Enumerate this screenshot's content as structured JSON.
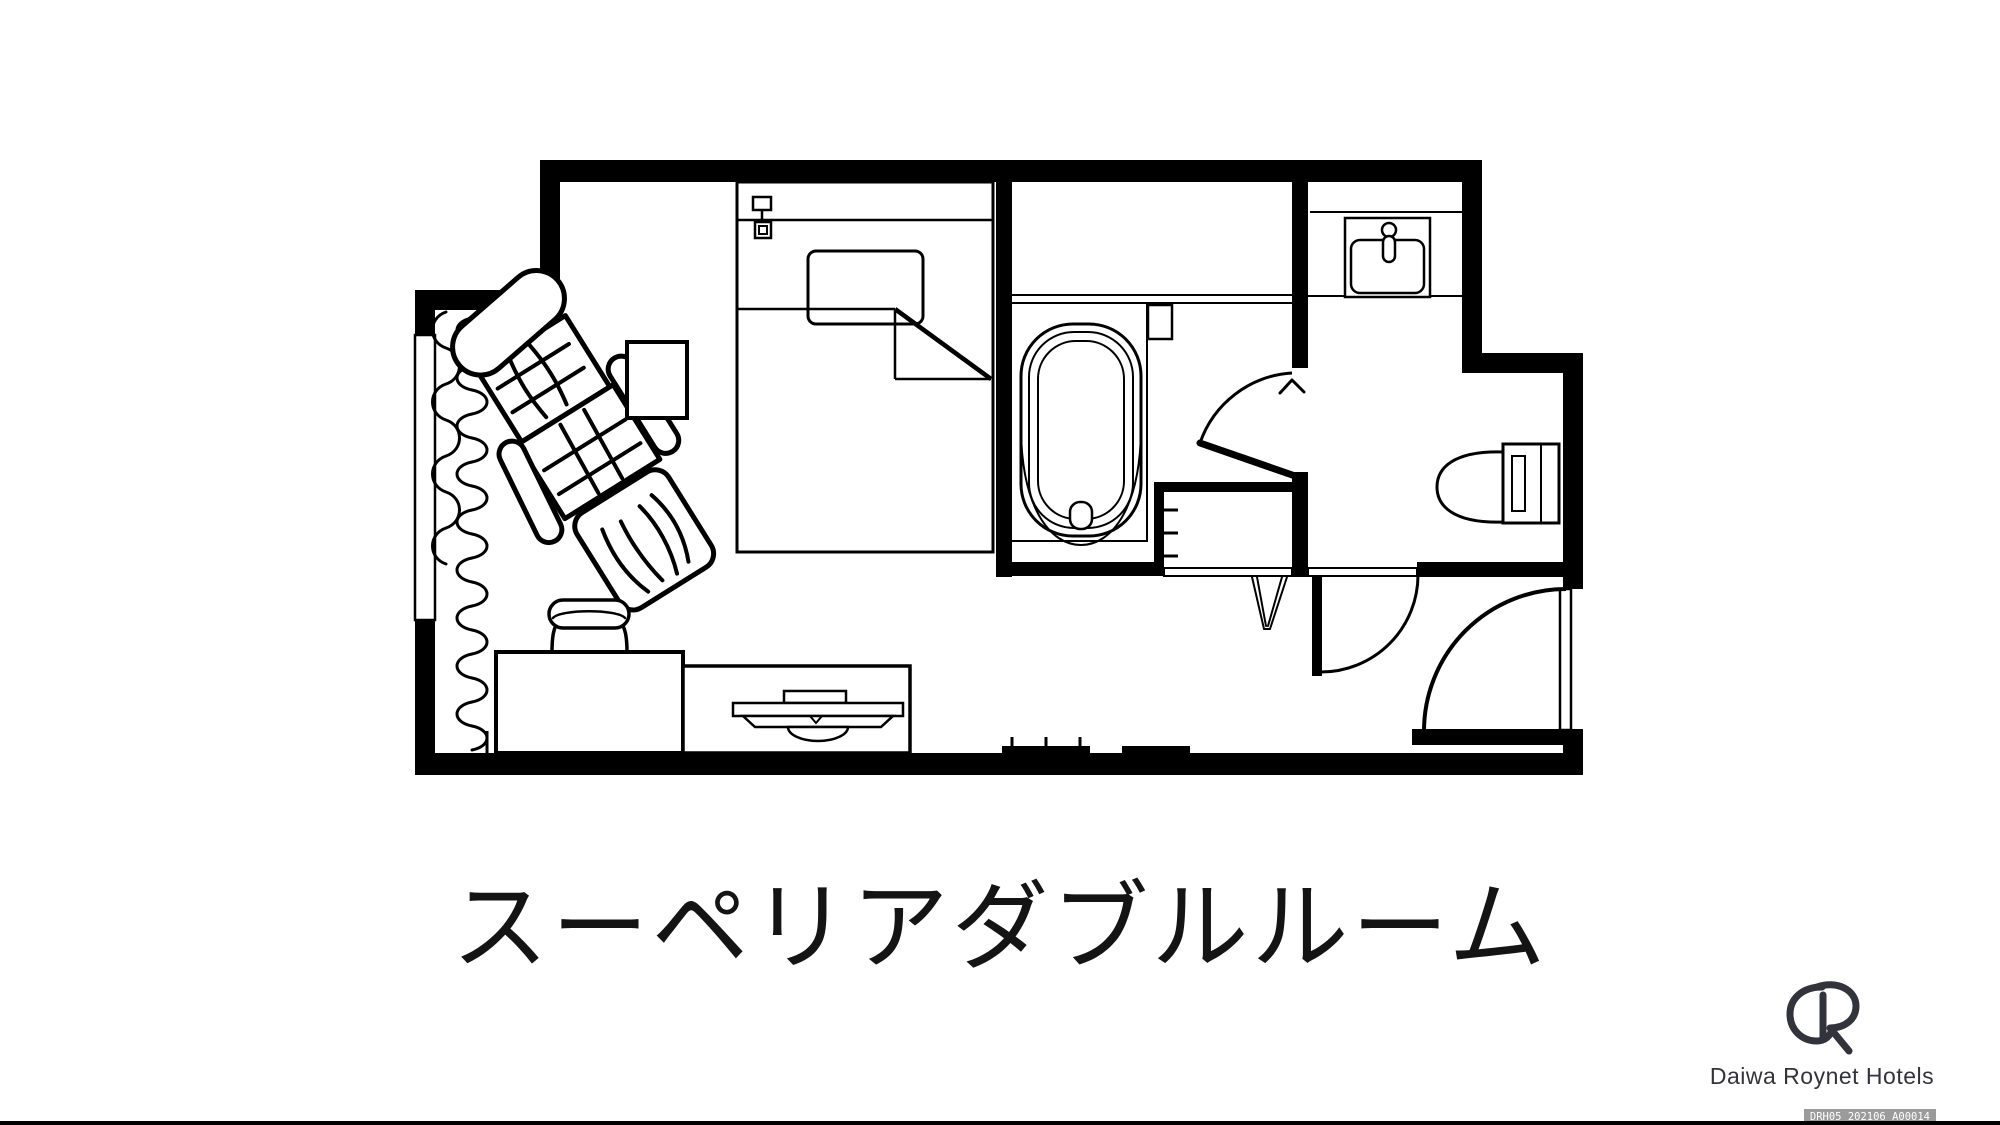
{
  "title": {
    "text": "スーペリアダブルルーム"
  },
  "branding": {
    "logo_icon": "daiwa-roynet-hotels-monogram",
    "name": "Daiwa Roynet Hotels",
    "badge": "DRH05_202106_A00014"
  },
  "floorplan": {
    "type": "hotel-guestroom-floor-plan",
    "rooms": [
      "main-bedroom",
      "bathroom",
      "vanity-washroom",
      "toilet-area",
      "closet",
      "entrance"
    ],
    "fixtures": [
      "double-bed",
      "pillow",
      "headboard-light",
      "lounge-chair",
      "side-table",
      "window-curtains",
      "desk",
      "stool",
      "tv-board",
      "television",
      "bathtub",
      "bath-deck",
      "washbasin",
      "toilet",
      "clothes-hanger",
      "shelf-ticks",
      "bathroom-door",
      "washroom-door",
      "entrance-door",
      "entrance-step"
    ],
    "colors": {
      "line": "#000000",
      "background": "#ffffff",
      "badge_bg": "#9b9b9b",
      "badge_text": "#ffffff",
      "brand_text": "#33333b"
    }
  }
}
